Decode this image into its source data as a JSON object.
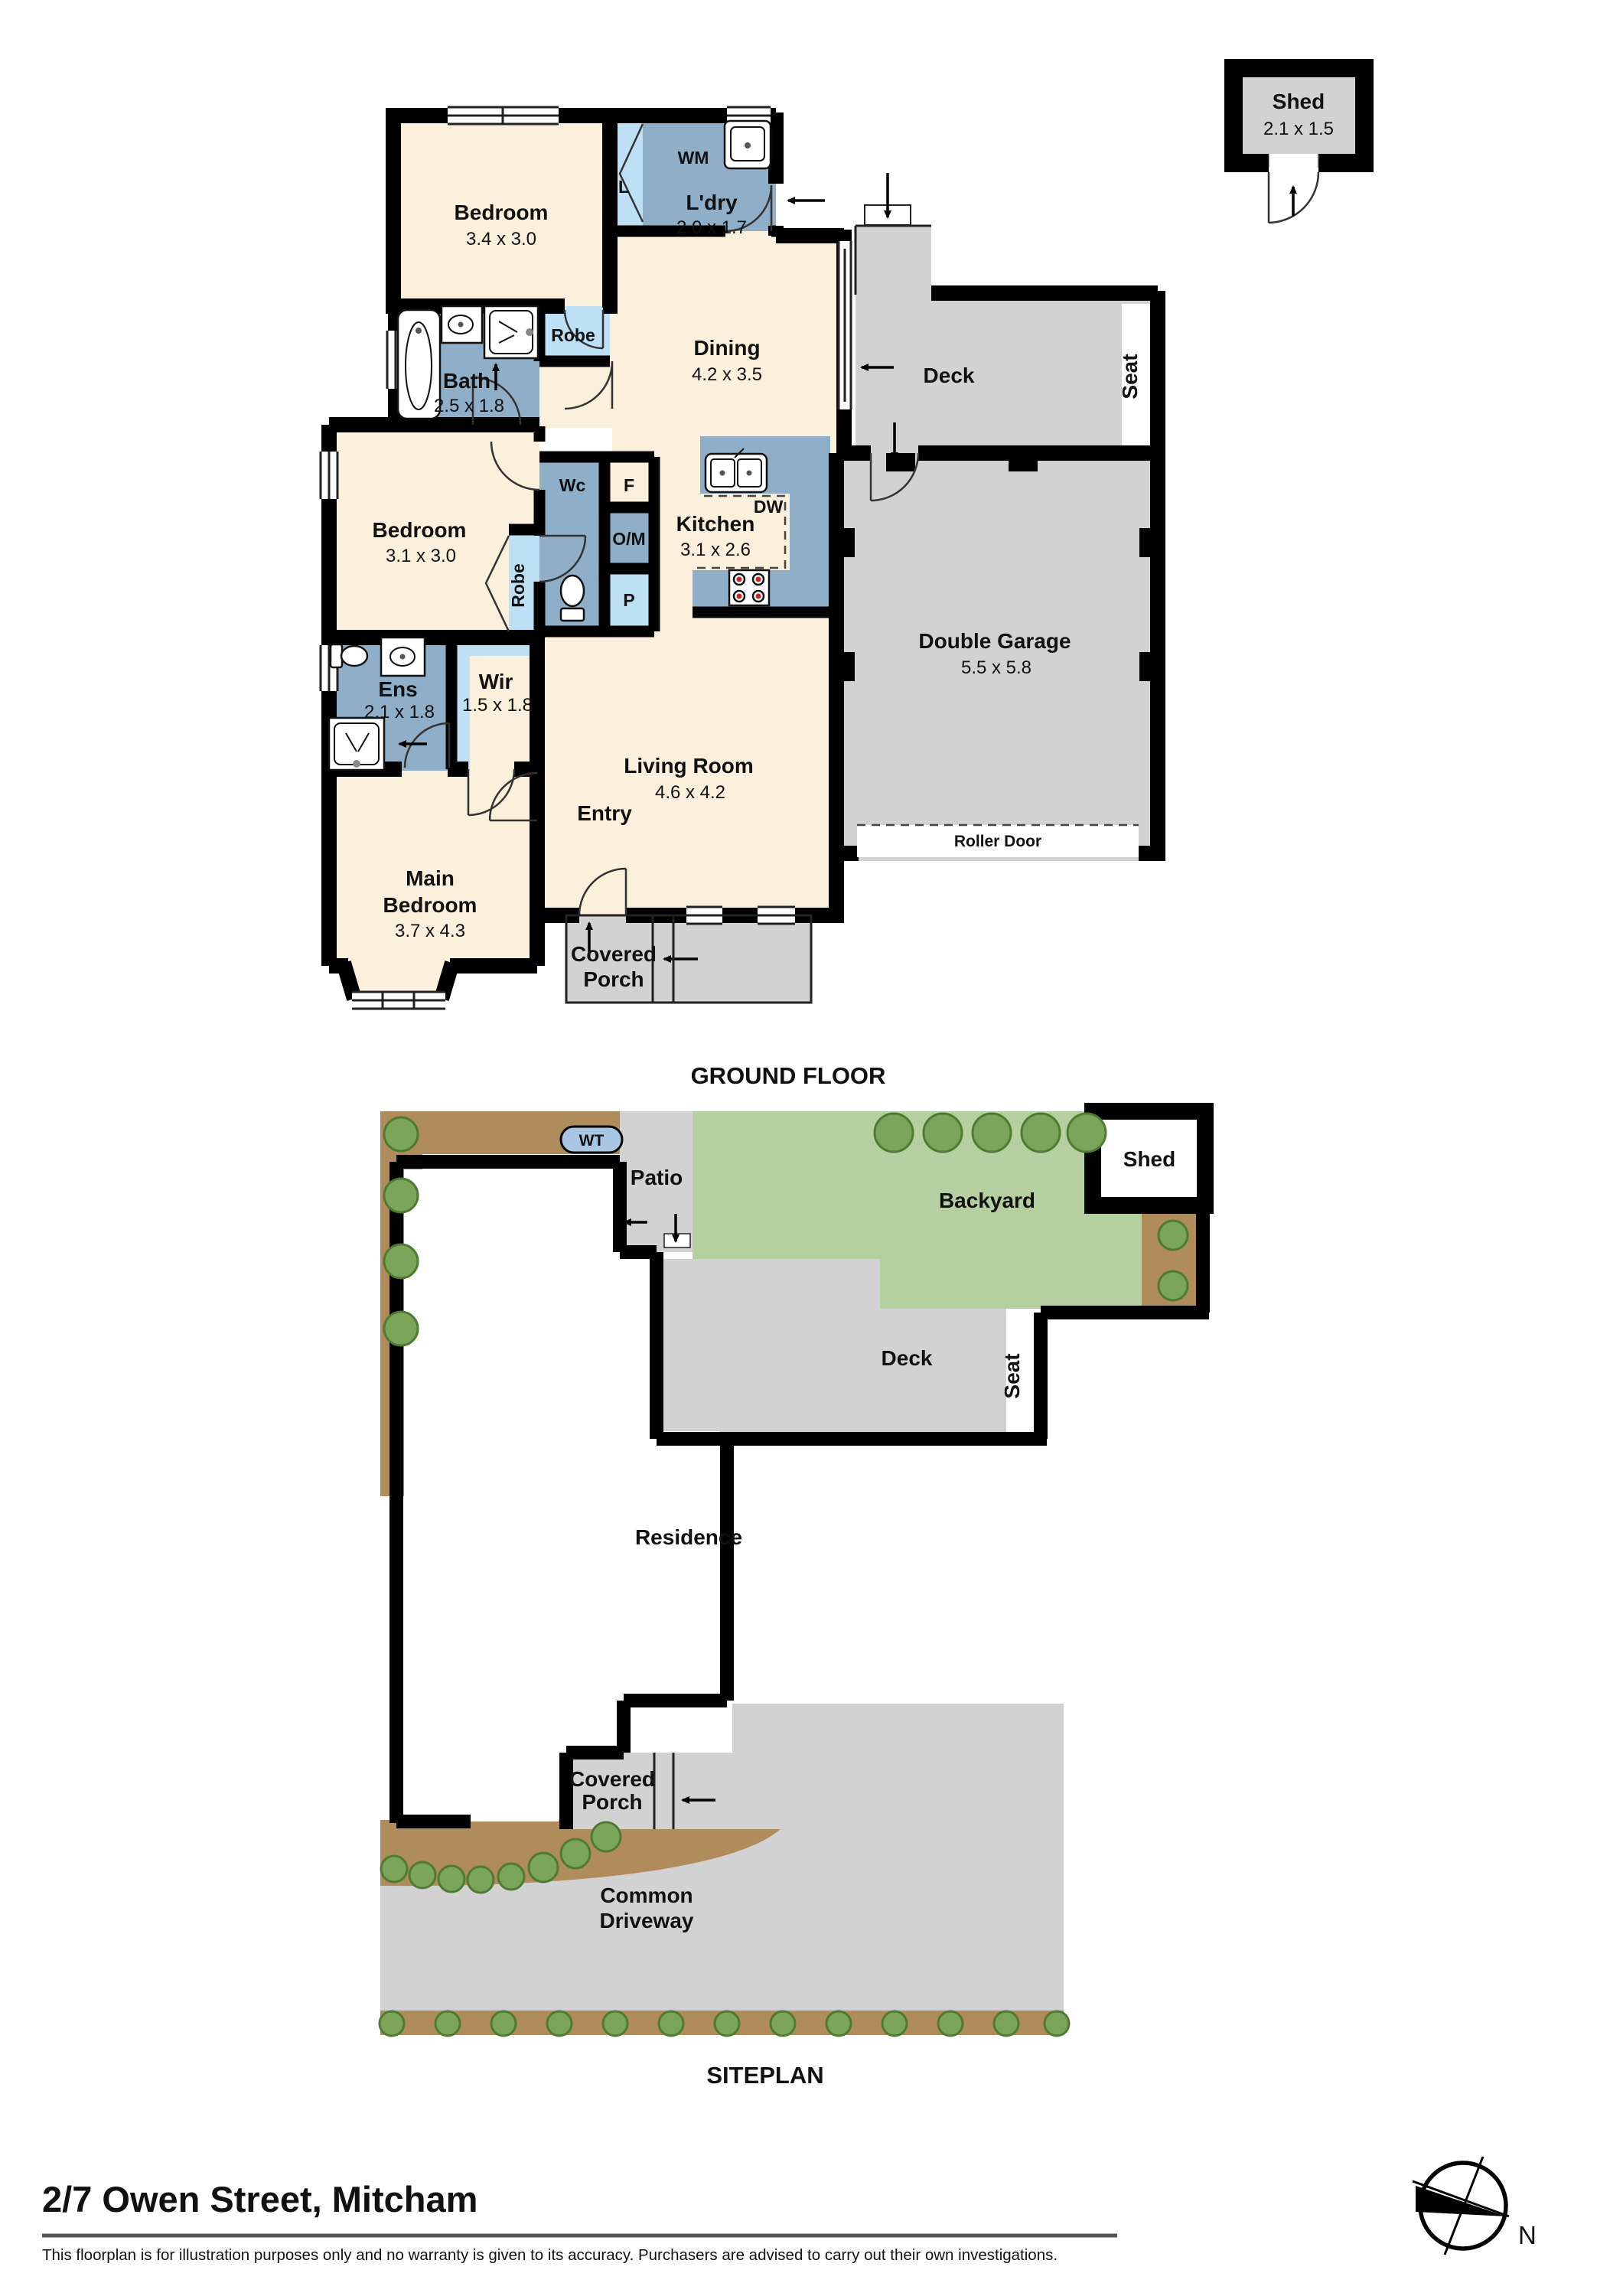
{
  "ground_floor": {
    "section_title": "GROUND FLOOR",
    "shed": {
      "name": "Shed",
      "dims": "2.1 x 1.5"
    },
    "bedroom_top": {
      "name": "Bedroom",
      "dims": "3.4 x 3.0"
    },
    "laundry": {
      "name": "L'dry",
      "dims": "2.0 x 1.7",
      "wm": "WM",
      "linen": "L"
    },
    "dining": {
      "name": "Dining",
      "dims": "4.2 x 3.5"
    },
    "deck": {
      "name": "Deck",
      "seat": "Seat"
    },
    "bath": {
      "name": "Bath",
      "dims": "2.5 x 1.8"
    },
    "robe_top": "Robe",
    "bedroom_mid": {
      "name": "Bedroom",
      "dims": "3.1 x 3.0"
    },
    "robe_mid": "Robe",
    "wc": "Wc",
    "fridge": "F",
    "oven_micro": "O/M",
    "pantry": "P",
    "kitchen": {
      "name": "Kitchen",
      "dims": "3.1 x 2.6",
      "dw": "DW"
    },
    "garage": {
      "name": "Double Garage",
      "dims": "5.5 x 5.8",
      "roller_door": "Roller Door"
    },
    "ensuite": {
      "name": "Ens",
      "dims": "2.1 x 1.8"
    },
    "wir": {
      "name": "Wir",
      "dims": "1.5 x 1.8"
    },
    "living": {
      "name": "Living Room",
      "dims": "4.6 x 4.2"
    },
    "entry": "Entry",
    "main_bedroom": {
      "line1": "Main",
      "line2": "Bedroom",
      "dims": "3.7 x 4.3"
    },
    "porch": {
      "line1": "Covered",
      "line2": "Porch"
    }
  },
  "siteplan": {
    "section_title": "SITEPLAN",
    "water_tank": "WT",
    "patio": "Patio",
    "backyard": "Backyard",
    "shed": "Shed",
    "deck": "Deck",
    "seat": "Seat",
    "residence": "Residence",
    "porch": {
      "line1": "Covered",
      "line2": "Porch"
    },
    "driveway": {
      "line1": "Common",
      "line2": "Driveway"
    }
  },
  "footer": {
    "address": "2/7 Owen Street, Mitcham",
    "disclaimer": "This floorplan is for illustration purposes only and no warranty is given to its accuracy. Purchasers are advised to carry out their own investigations.",
    "compass_n": "N"
  },
  "colors": {
    "room_fill": "#FAF0DC",
    "wet_fill": "#8FAEC8",
    "closet_fill": "#BEE0F4",
    "hard_fill": "#D2D2D2",
    "grass_fill": "#B6CFA0",
    "garden_fill": "#B08B5C",
    "tank_fill": "#A9C7E2",
    "wall": "#000000"
  }
}
